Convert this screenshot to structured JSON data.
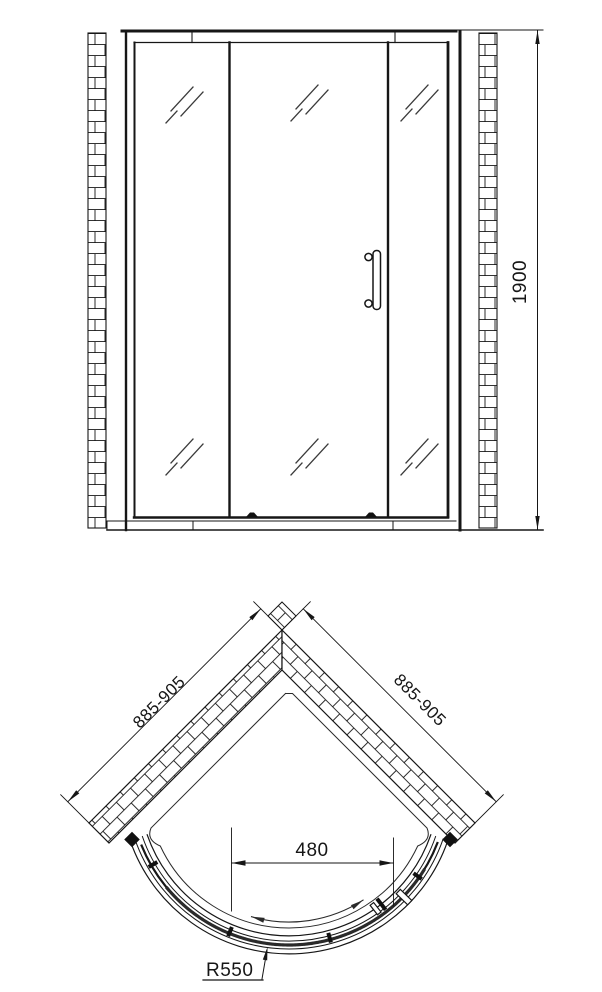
{
  "front_view": {
    "height_dimension": "1900"
  },
  "plan_view": {
    "left_wall_dimension": "885-905",
    "right_wall_dimension": "885-905",
    "door_opening_dimension": "480",
    "radius_dimension": "R550"
  },
  "colors": {
    "line": "#161616",
    "background": "#ffffff"
  }
}
